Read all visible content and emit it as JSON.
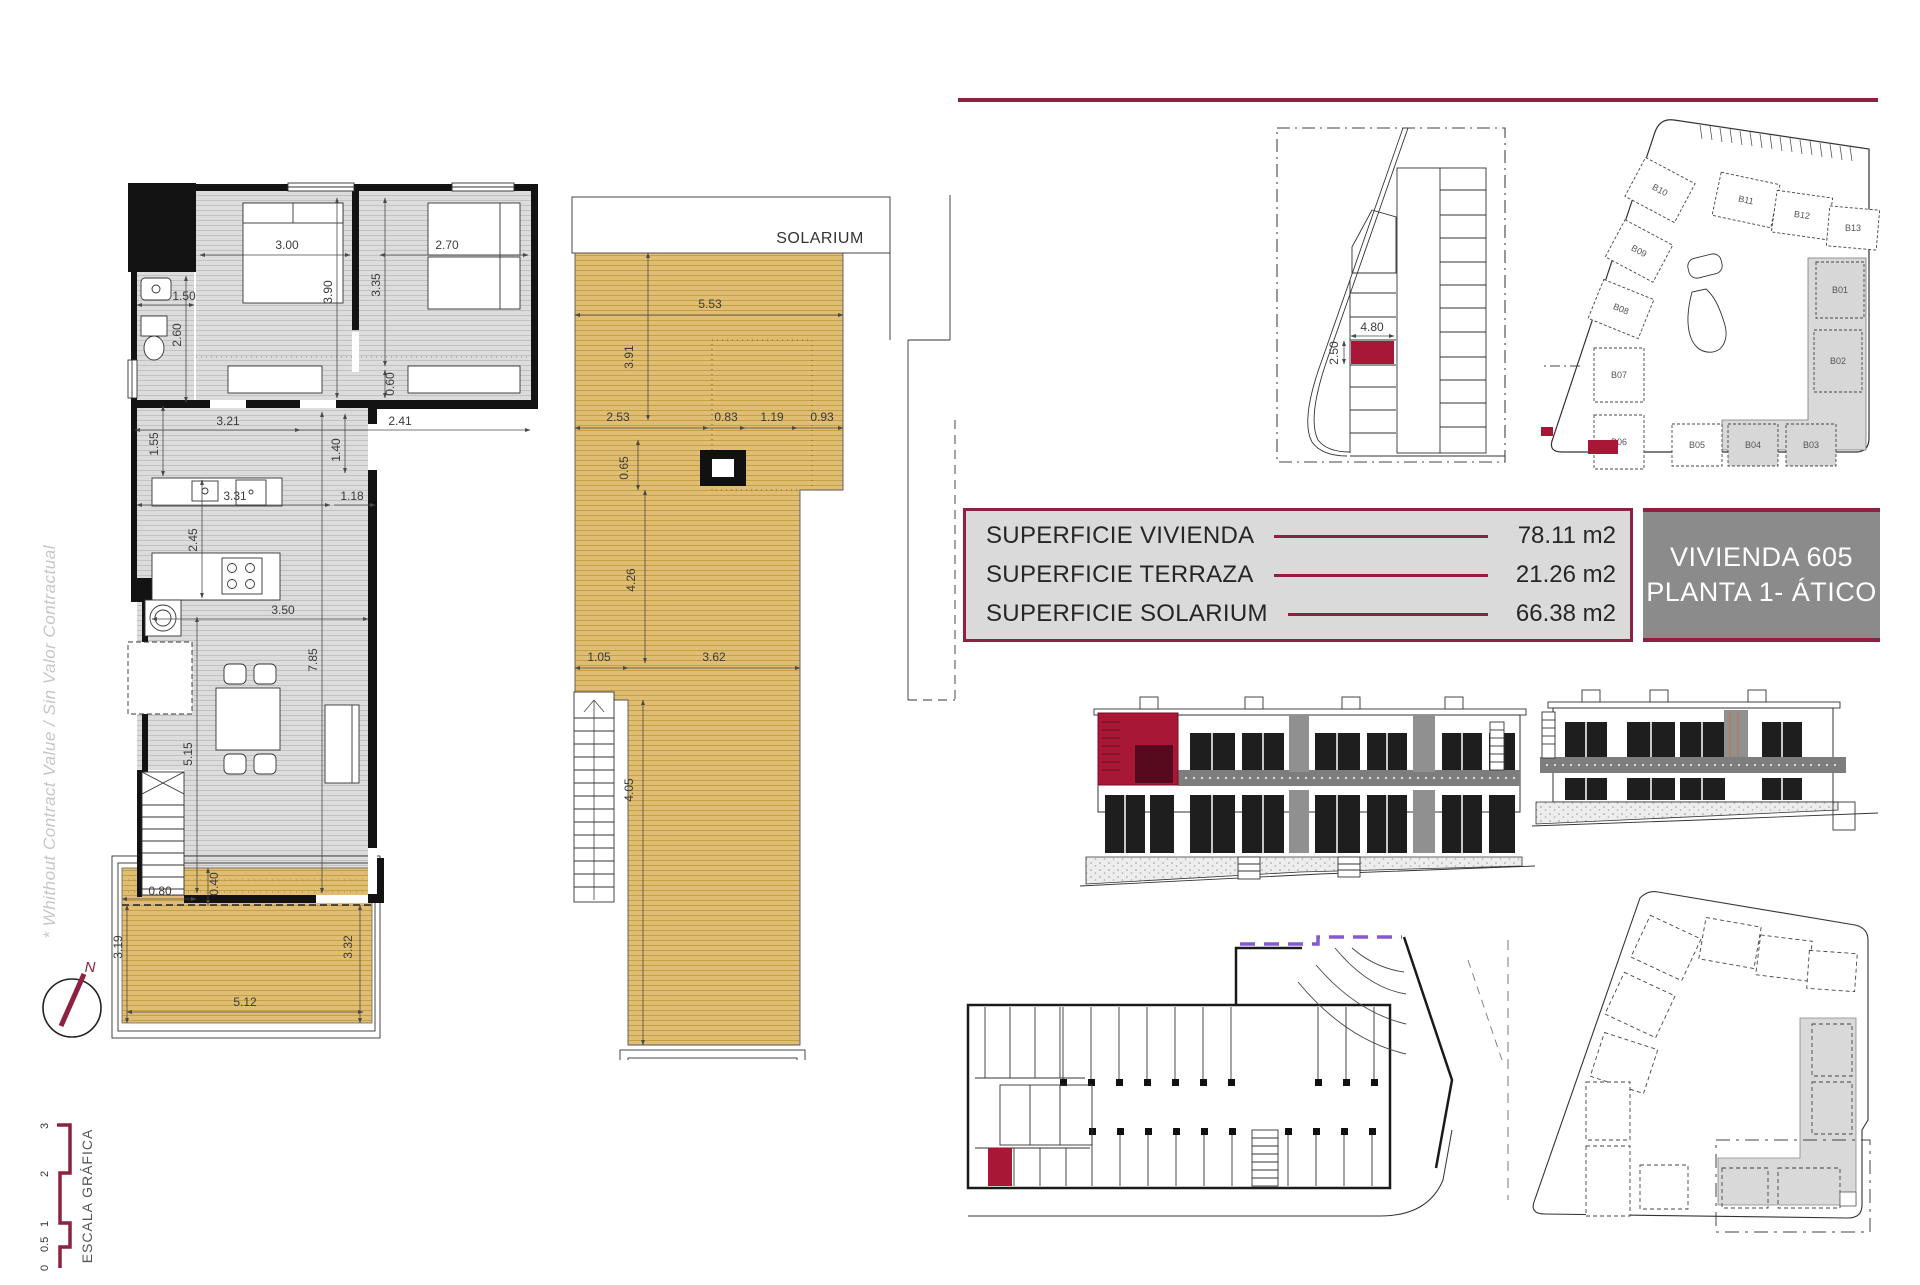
{
  "document": {
    "disclaimer": "* Whithout Contract Value / Sin Valor Contractual",
    "compass_north": "N",
    "scale_bar": {
      "title": "ESCALA GRÁFICA",
      "ticks": [
        "0",
        "0.5",
        "1",
        "2",
        "3"
      ]
    }
  },
  "surface_table": {
    "rows": [
      {
        "label": "SUPERFICIE VIVIENDA",
        "value": "78.11 m2"
      },
      {
        "label": "SUPERFICIE TERRAZA",
        "value": "21.26 m2"
      },
      {
        "label": "SUPERFICIE SOLARIUM",
        "value": "66.38 m2"
      }
    ]
  },
  "title_box": {
    "unit": "VIVIENDA 605",
    "floor": "PLANTA 1- ÁTICO"
  },
  "floor_plan": {
    "dims": {
      "bedroom1_width": "3.00",
      "bedroom1_depth": "3.90",
      "bedroom2_width": "2.70",
      "bedroom2_depth": "3.35",
      "bedroom2_wardrobe": "0.60",
      "bathroom_width": "1.50",
      "bathroom_depth": "2.60",
      "hall_left": "3.21",
      "hall_right": "2.41",
      "hall_depth": "1.40",
      "entry_depth": "1.55",
      "kitchen_width": "3.31",
      "passage_width": "1.18",
      "kitchen_depth": "2.45",
      "living_width": "3.50",
      "living_depth": "7.85",
      "living_side": "5.15",
      "terrace_offset_w": "0.80",
      "terrace_offset_d": "0.40",
      "terrace_left": "3.19",
      "terrace_right": "3.32",
      "terrace_width": "5.12"
    }
  },
  "solarium_plan": {
    "title": "SOLARIUM",
    "dims": {
      "top_width": "5.53",
      "top_depth": "3.91",
      "left_width": "2.53",
      "skylight_left": "0.83",
      "skylight_width": "1.19",
      "skylight_right": "0.93",
      "skylight_depth": "0.65",
      "mid_depth": "4.26",
      "stair_width": "1.05",
      "lower_width": "3.62",
      "lower_depth": "4.05"
    }
  },
  "parking_plan": {
    "stall_width": "4.80",
    "stall_depth": "2.50"
  },
  "site_plan": {
    "blocks": {
      "b01": "B01",
      "b02": "B02",
      "b03": "B03",
      "b04": "B04",
      "b05": "B05",
      "b06": "B06",
      "b07": "B07",
      "b08": "B08",
      "b09": "B09",
      "b10": "B10",
      "b11": "B11",
      "b12": "B12",
      "b13": "B13"
    }
  },
  "colors": {
    "maroon": "#8E2140",
    "highlight_red": "#A81735",
    "solarium_tan": "#DFBD72",
    "floor_gray": "#DCDCDC",
    "title_gray": "#8B8B8B",
    "table_gray": "#DADADA",
    "ramp_purple": "#8759CF"
  }
}
